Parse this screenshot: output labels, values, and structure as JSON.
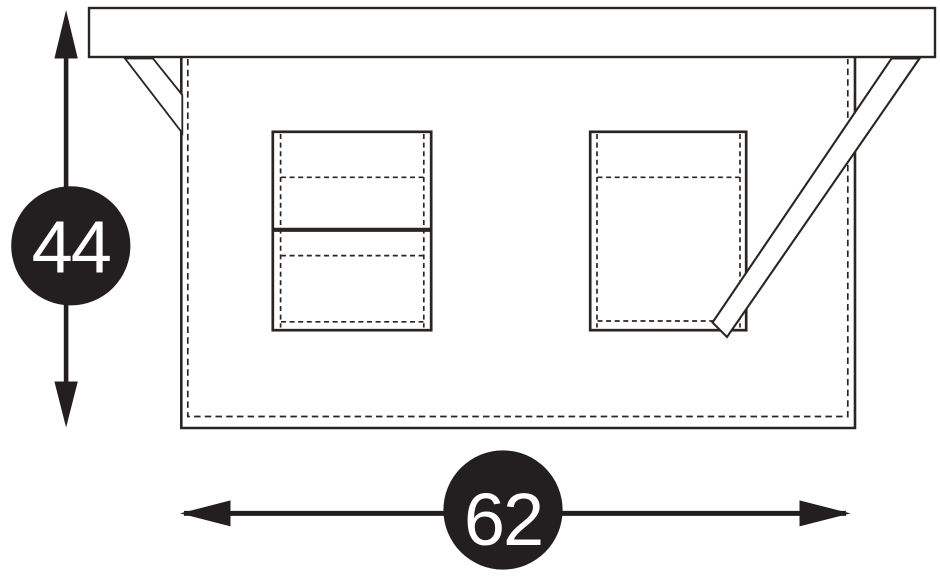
{
  "colors": {
    "line": "#2b2522",
    "badge_fill": "#231f20",
    "badge_text": "#ffffff",
    "background": "#ffffff"
  },
  "dimensions": {
    "height": {
      "value": "44",
      "orientation": "vertical"
    },
    "width": {
      "value": "62",
      "orientation": "horizontal"
    }
  }
}
